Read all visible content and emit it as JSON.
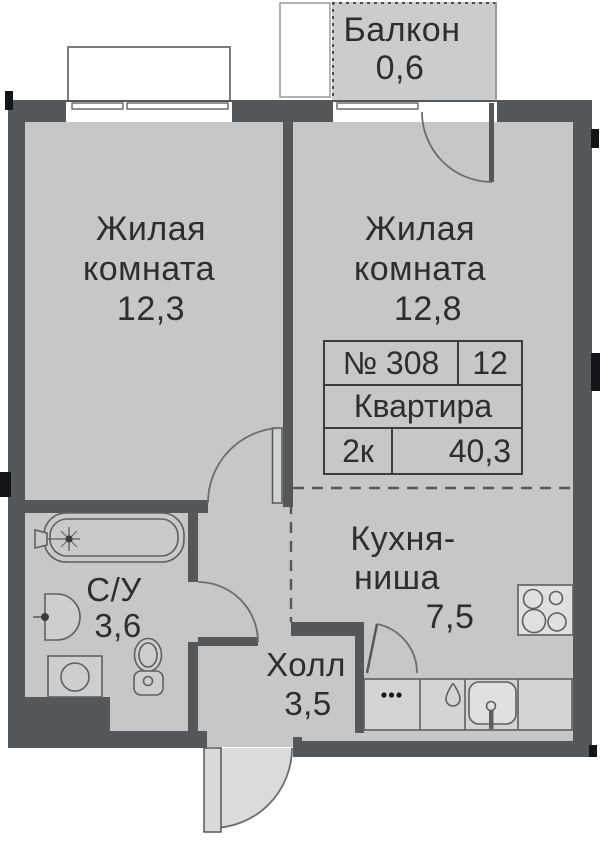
{
  "plan": {
    "balcony": {
      "name": "Балкон",
      "area": "0,6"
    },
    "room1": {
      "name_line1": "Жилая",
      "name_line2": "комната",
      "area": "12,3"
    },
    "room2": {
      "name_line1": "Жилая",
      "name_line2": "комната",
      "area": "12,8"
    },
    "kitchen": {
      "name_line1": "Кухня-",
      "name_line2": "ниша",
      "area": "7,5"
    },
    "hall": {
      "name": "Холл",
      "area": "3,5"
    },
    "bathroom": {
      "name": "С/У",
      "area": "3,6"
    },
    "info_table": {
      "number": "№ 308",
      "floor": "12",
      "type": "Квартира",
      "rooms": "2к",
      "total_area": "40,3"
    }
  },
  "colors": {
    "wall": "#55585b",
    "floor": "#c6c7c8",
    "balcony_floor": "#cbcccd",
    "fixture_outline": "#5d6063",
    "text": "#2c2e30",
    "outside": "#ffffff"
  }
}
